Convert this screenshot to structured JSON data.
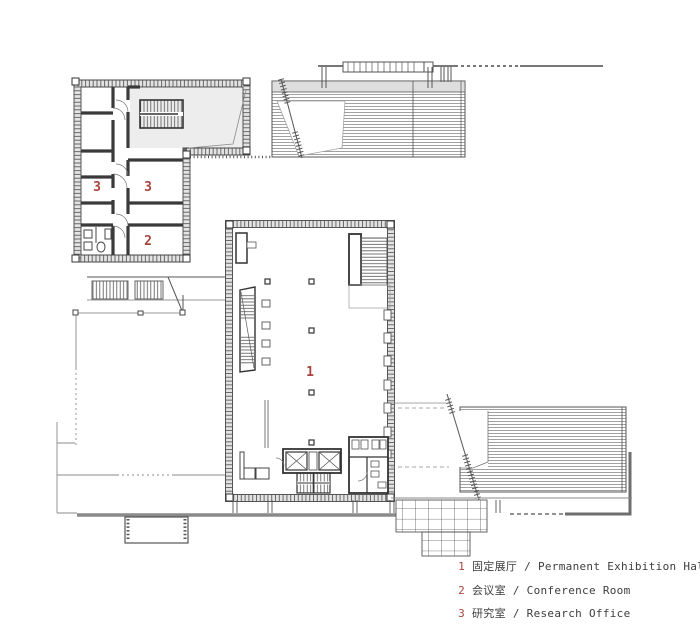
{
  "colors": {
    "accent_red": "#a8443c",
    "line_dark": "#3f3f3f",
    "line_mid": "#6e6e6e",
    "wall_fill": "#e3e3e3"
  },
  "plan": {
    "room_labels": {
      "exhibition_hall": "1",
      "conference_room": "2",
      "research_office_left": "3",
      "research_office_right": "3"
    }
  },
  "legend": {
    "items": [
      {
        "number": "1",
        "label": "固定展厅 / Permanent Exhibition Hall"
      },
      {
        "number": "2",
        "label": "会议室 / Conference Room"
      },
      {
        "number": "3",
        "label": "研究室 / Research Office"
      }
    ]
  }
}
